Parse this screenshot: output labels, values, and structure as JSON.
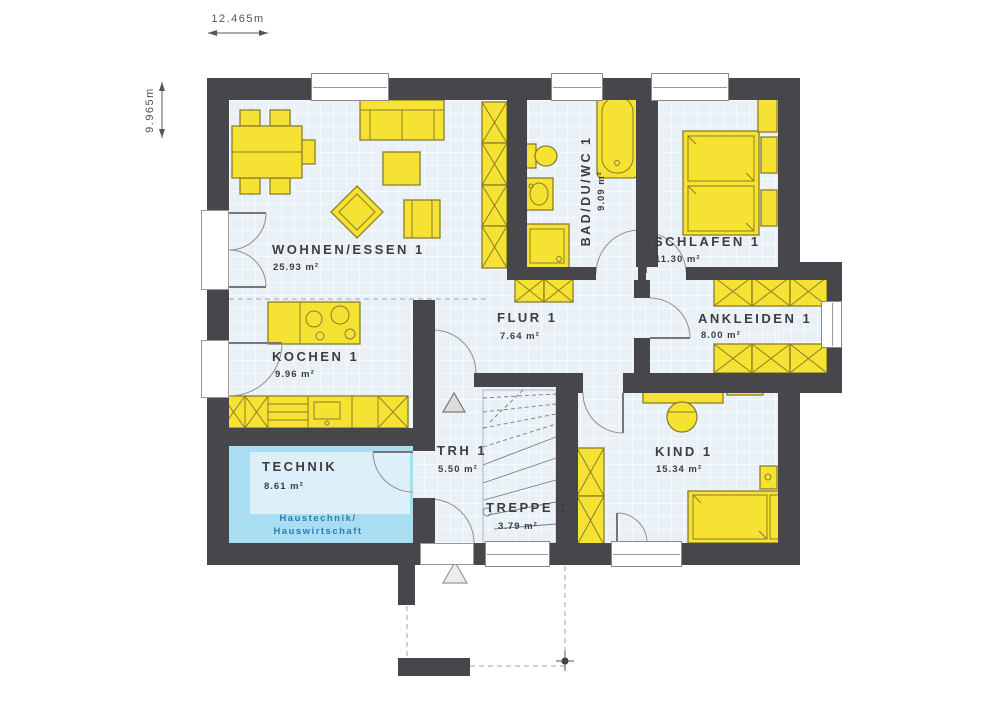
{
  "dimensions": {
    "width": "12.465m",
    "height": "9.965m"
  },
  "rooms": {
    "wohnen_essen": {
      "name": "WOHNEN/ESSEN 1",
      "area": "25.93 m²"
    },
    "kochen": {
      "name": "KOCHEN 1",
      "area": "9.96 m²"
    },
    "bad_du_wc": {
      "name": "BAD/DU/WC 1",
      "area": "9.09 m²"
    },
    "schlafen": {
      "name": "SCHLAFEN 1",
      "area": "11.30 m²"
    },
    "ankleiden": {
      "name": "ANKLEIDEN 1",
      "area": "8.00 m²"
    },
    "flur": {
      "name": "FLUR 1",
      "area": "7.64 m²"
    },
    "kind": {
      "name": "KIND 1",
      "area": "15.34 m²"
    },
    "trh": {
      "name": "TRH 1",
      "area": "5.50 m²"
    },
    "treppe": {
      "name": "TREPPE 1",
      "area": "3.79 m²"
    },
    "technik": {
      "name": "TECHNIK",
      "area": "8.61 m²",
      "note_line1": "Haustechnik/",
      "note_line2": "Hauswirtschaft"
    }
  },
  "colors": {
    "wall": "#47474b",
    "floor": "#e9f1f7",
    "furniture": "#f5e233",
    "furniture_outline": "#8a7e2a",
    "technik_floor": "#a9ddf1",
    "technik_note_text": "#2e7cb8",
    "label_text": "#3d3d40"
  }
}
